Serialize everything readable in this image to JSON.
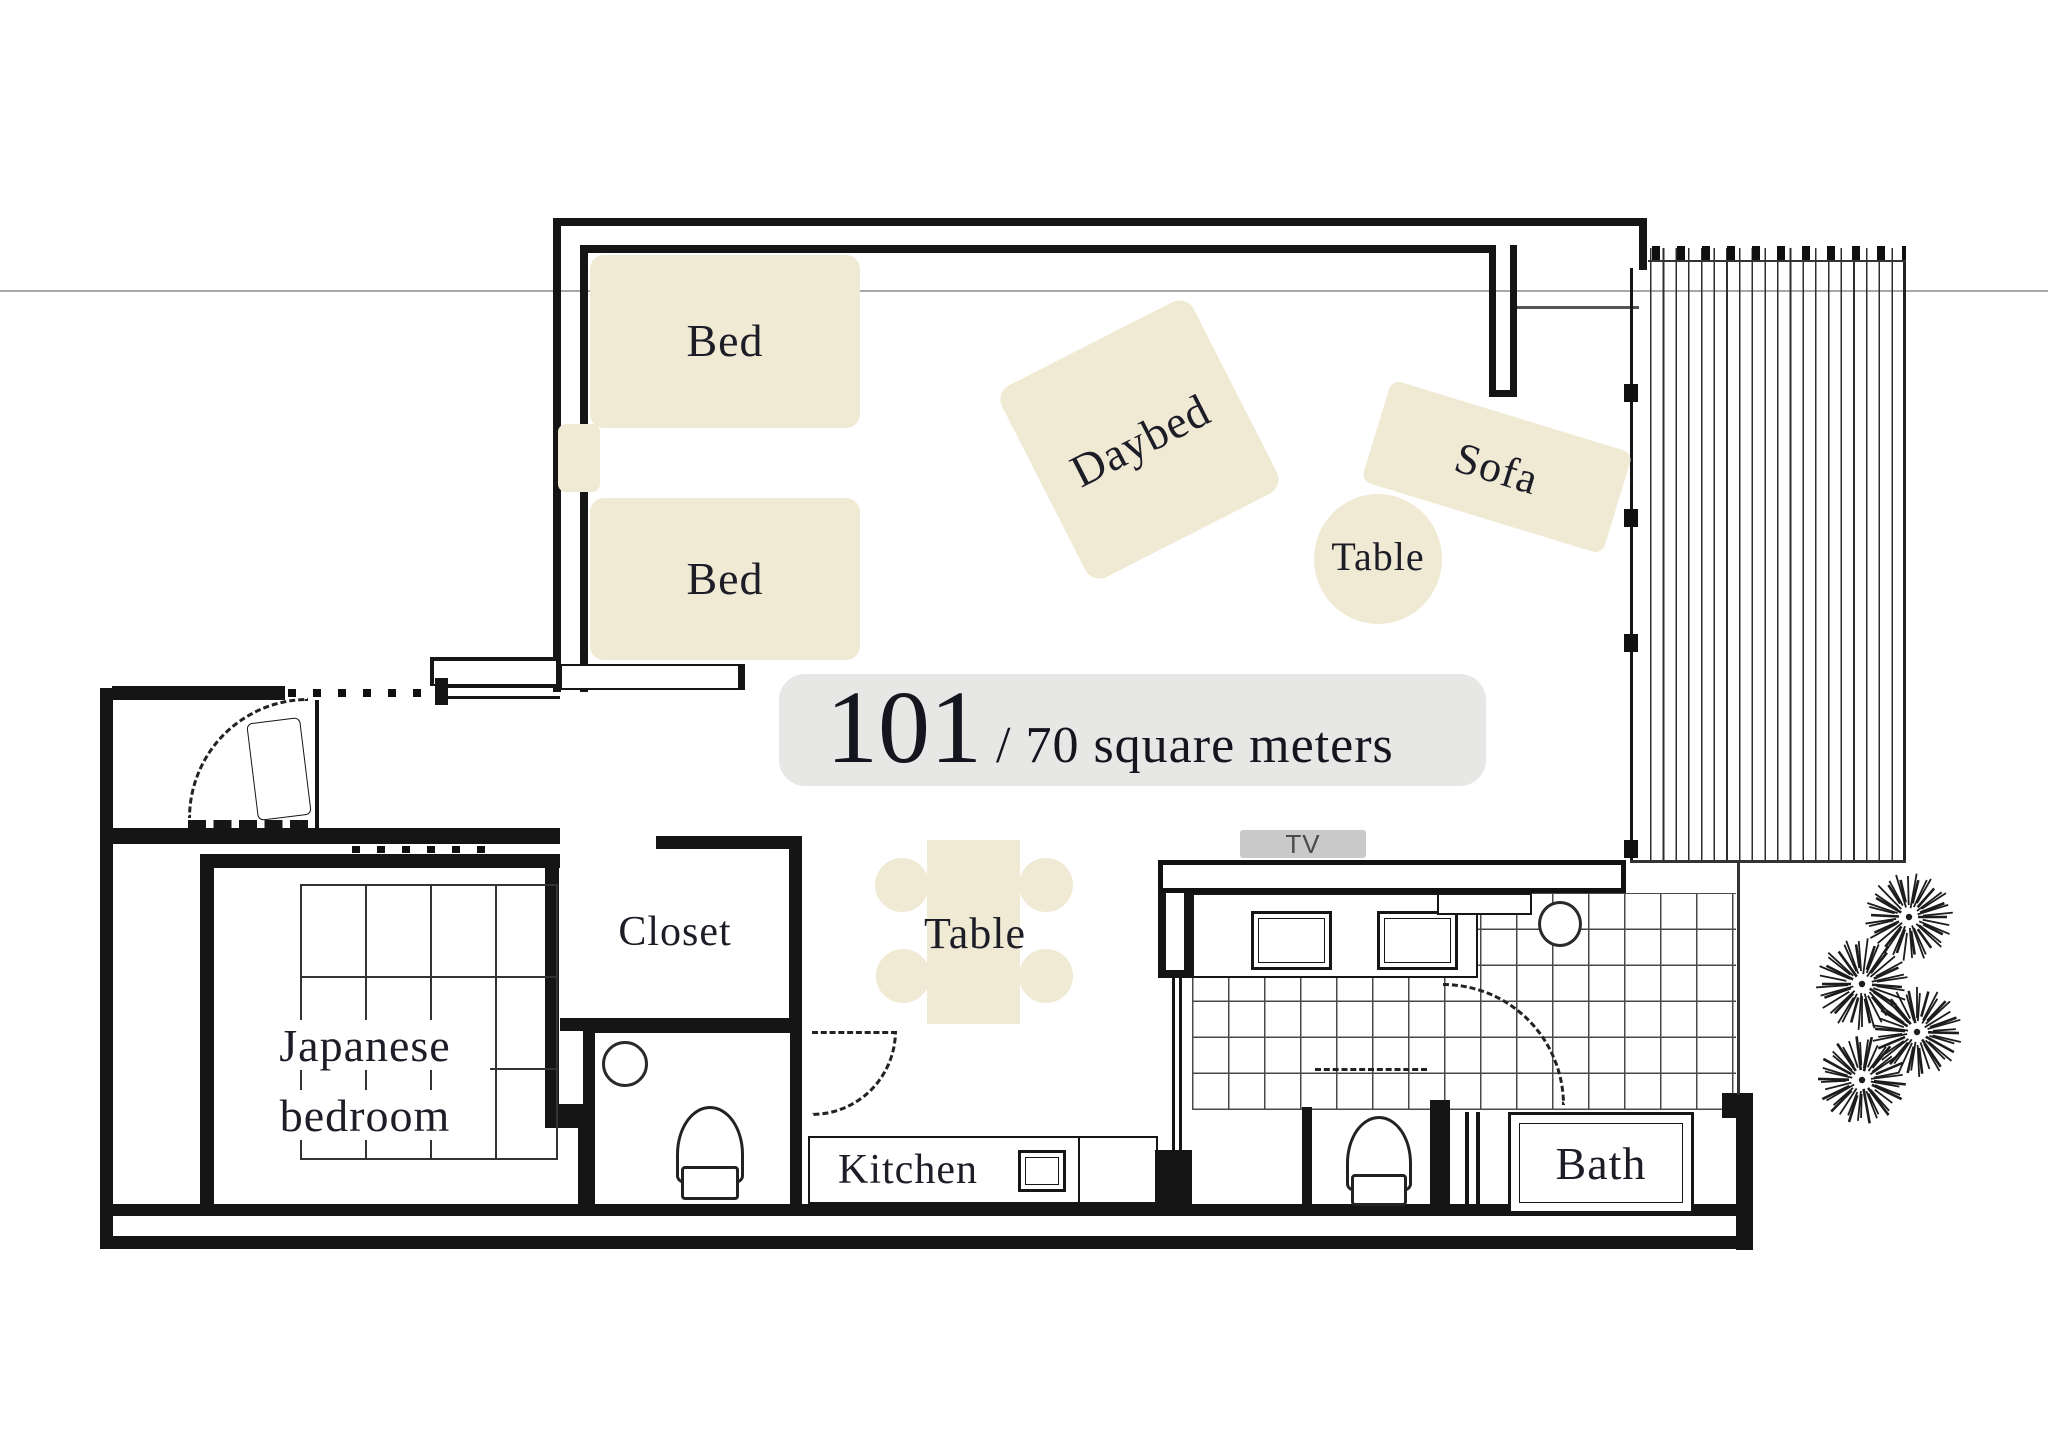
{
  "badge": {
    "number": "101",
    "area": "/ 70 square meters"
  },
  "labels": {
    "bed1": "Bed",
    "bed2": "Bed",
    "daybed": "Daybed",
    "sofa": "Sofa",
    "side_table": "Table",
    "dining_table": "Table",
    "japanese_bedroom_line1": "Japanese",
    "japanese_bedroom_line2": "bedroom",
    "closet": "Closet",
    "kitchen": "Kitchen",
    "bath": "Bath",
    "tv": "TV"
  },
  "palette": {
    "furniture_fill": "#f0e9d3",
    "badge_bg": "#e7e7e6",
    "wall": "#151515",
    "label_text": "#1d1d28",
    "tv_bg": "#c9c9c9",
    "tv_text": "#4a4a4a",
    "tile_line": "#4a4a4a",
    "faint_line": "#a8a8a8"
  }
}
